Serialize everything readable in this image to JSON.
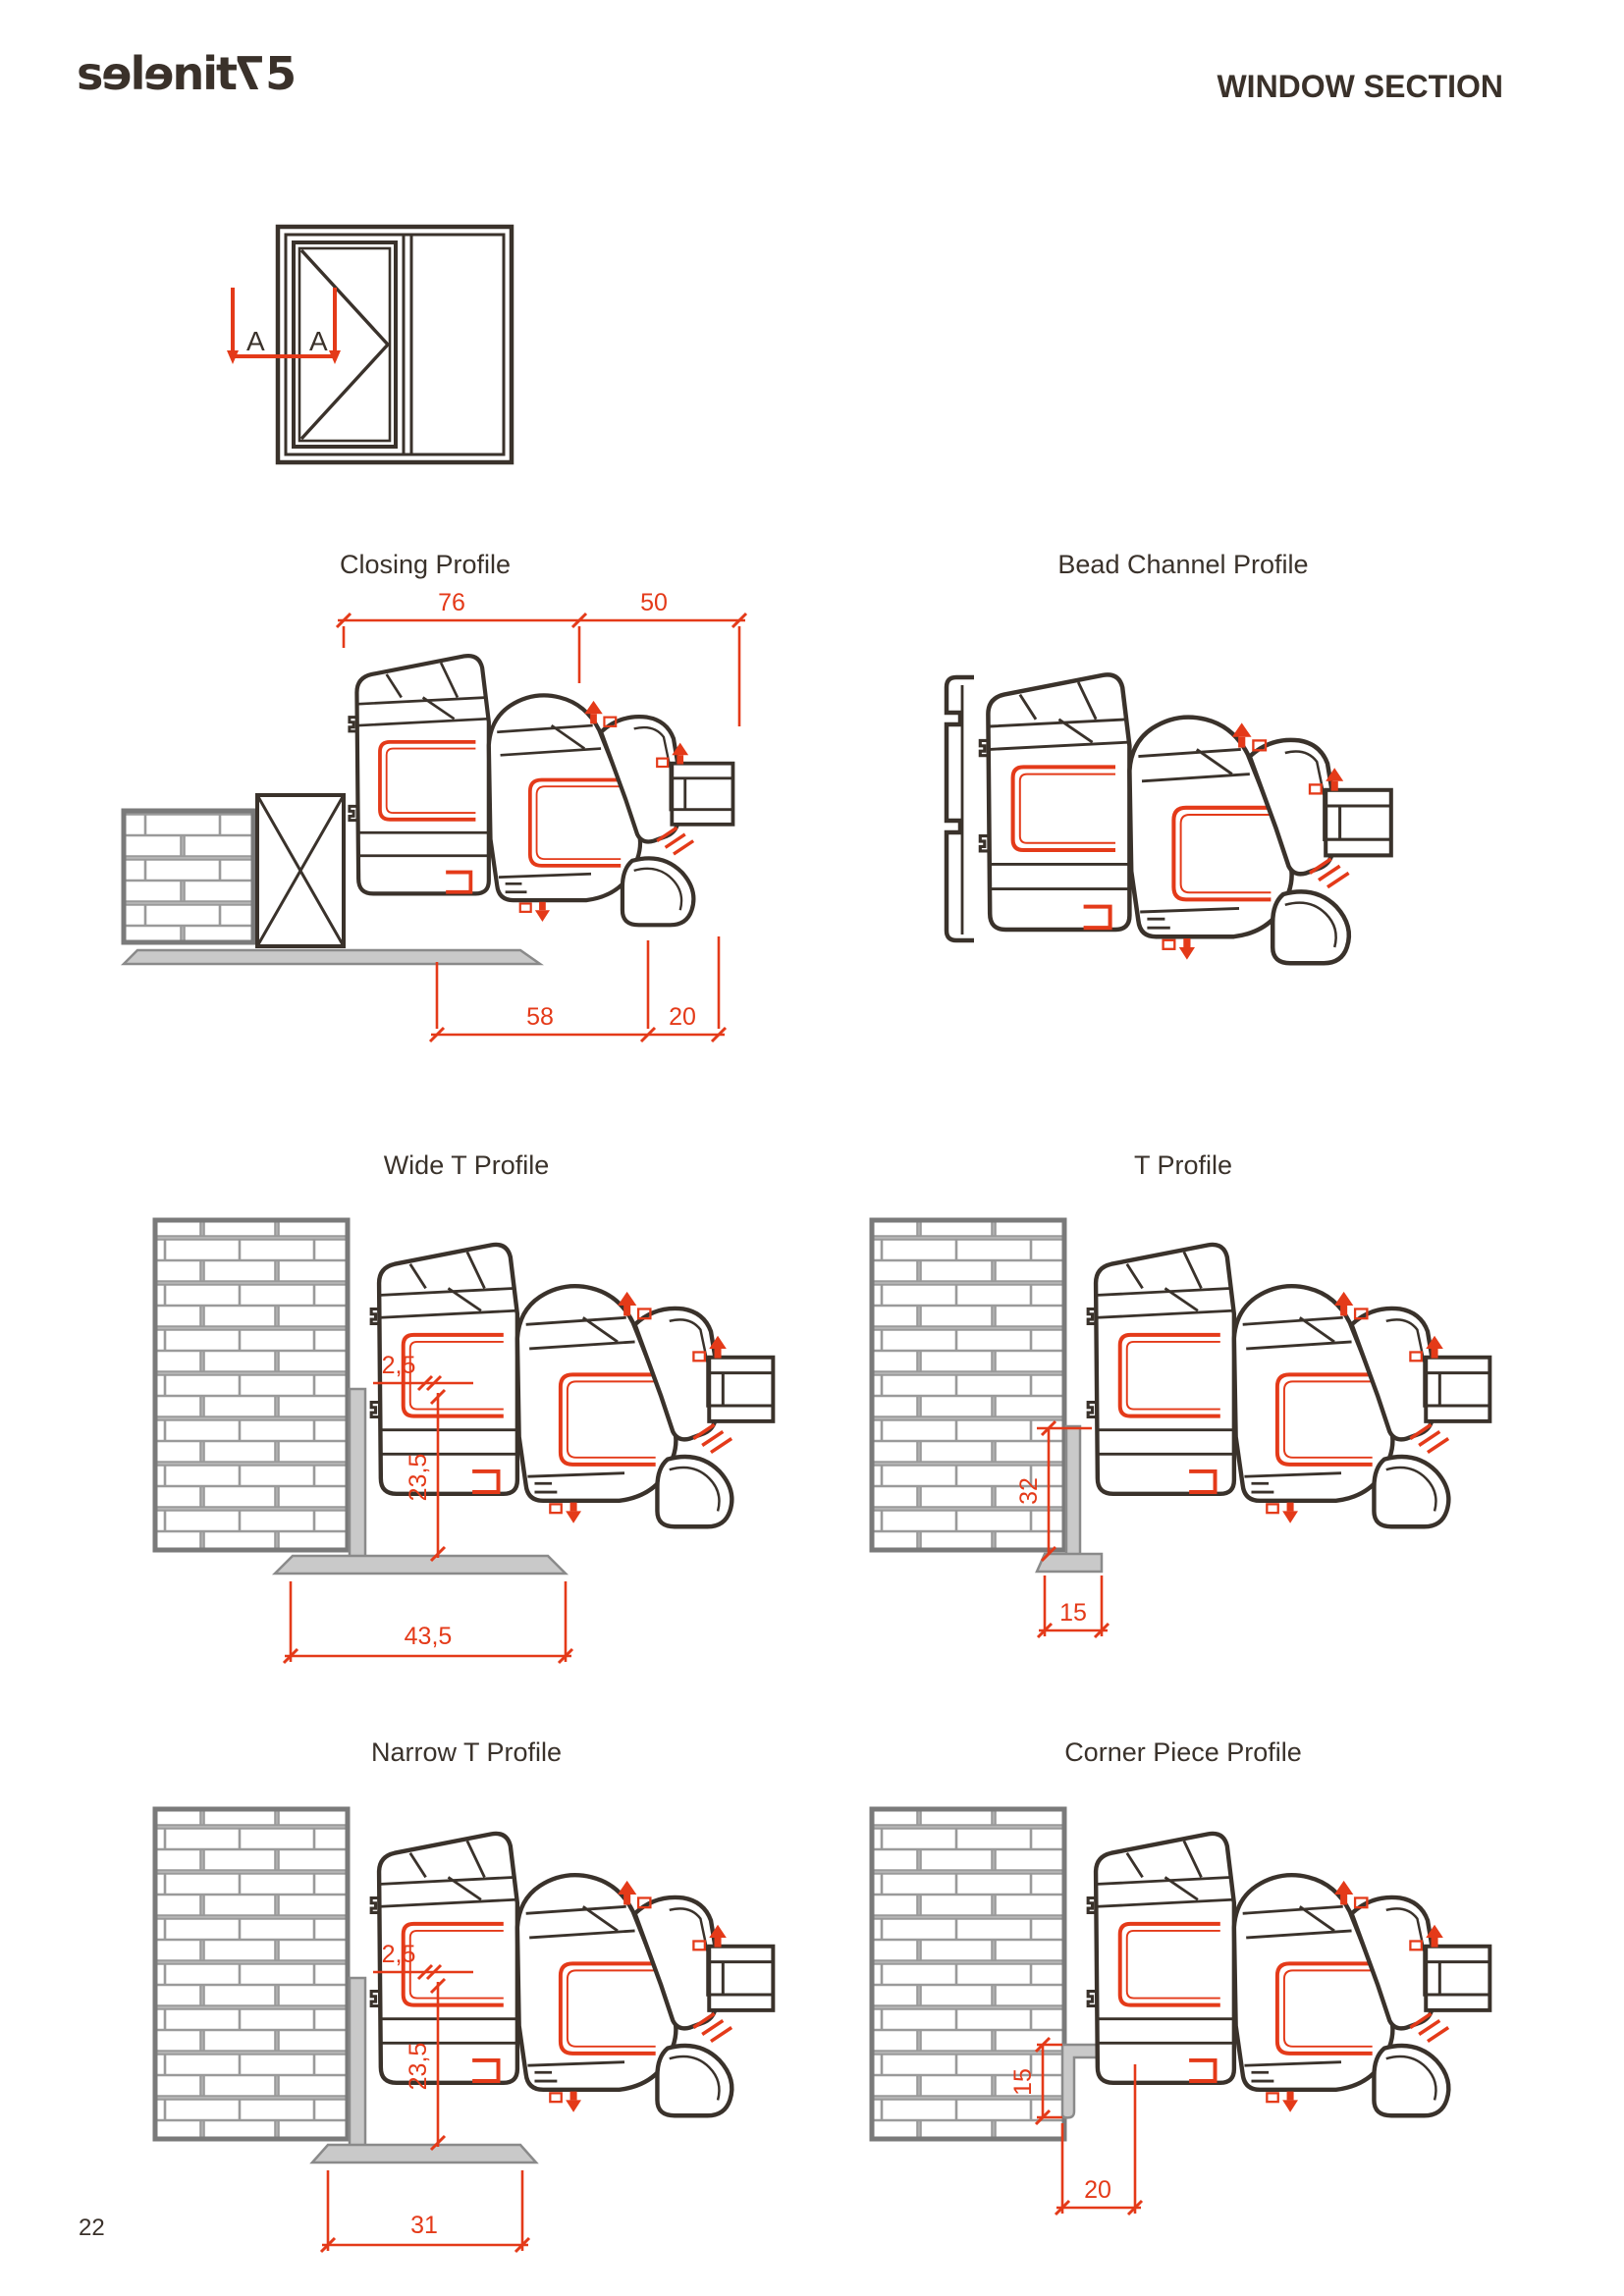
{
  "page": {
    "number": "22"
  },
  "header": {
    "logo": {
      "part1": "sɘlɘnit",
      "part2": "7",
      "part3": "5"
    },
    "title": "WINDOW SECTION"
  },
  "window_diagram": {
    "section_label_1": "A",
    "section_label_2": "A"
  },
  "colors": {
    "ink": "#3a322b",
    "dimension_red": "#e43a19",
    "wall_line_gray": "#9a9a9a",
    "wall_border_gray": "#7a7a7a",
    "accessory_gray": "#c9c9c9"
  },
  "profiles": [
    {
      "id": "closing",
      "title": "Closing Profile",
      "dims": [
        "76",
        "50",
        "58",
        "20"
      ]
    },
    {
      "id": "bead-channel",
      "title": "Bead Channel Profile",
      "dims": []
    },
    {
      "id": "wide-t",
      "title": "Wide T Profile",
      "dims": [
        "2,5",
        "23,5",
        "43,5"
      ]
    },
    {
      "id": "t",
      "title": "T Profile",
      "dims": [
        "32",
        "15"
      ]
    },
    {
      "id": "narrow-t",
      "title": "Narrow  T Profile",
      "dims": [
        "2,5",
        "23,5",
        "31"
      ]
    },
    {
      "id": "corner-piece",
      "title": "Corner Piece Profile",
      "dims": [
        "15",
        "20"
      ]
    }
  ]
}
